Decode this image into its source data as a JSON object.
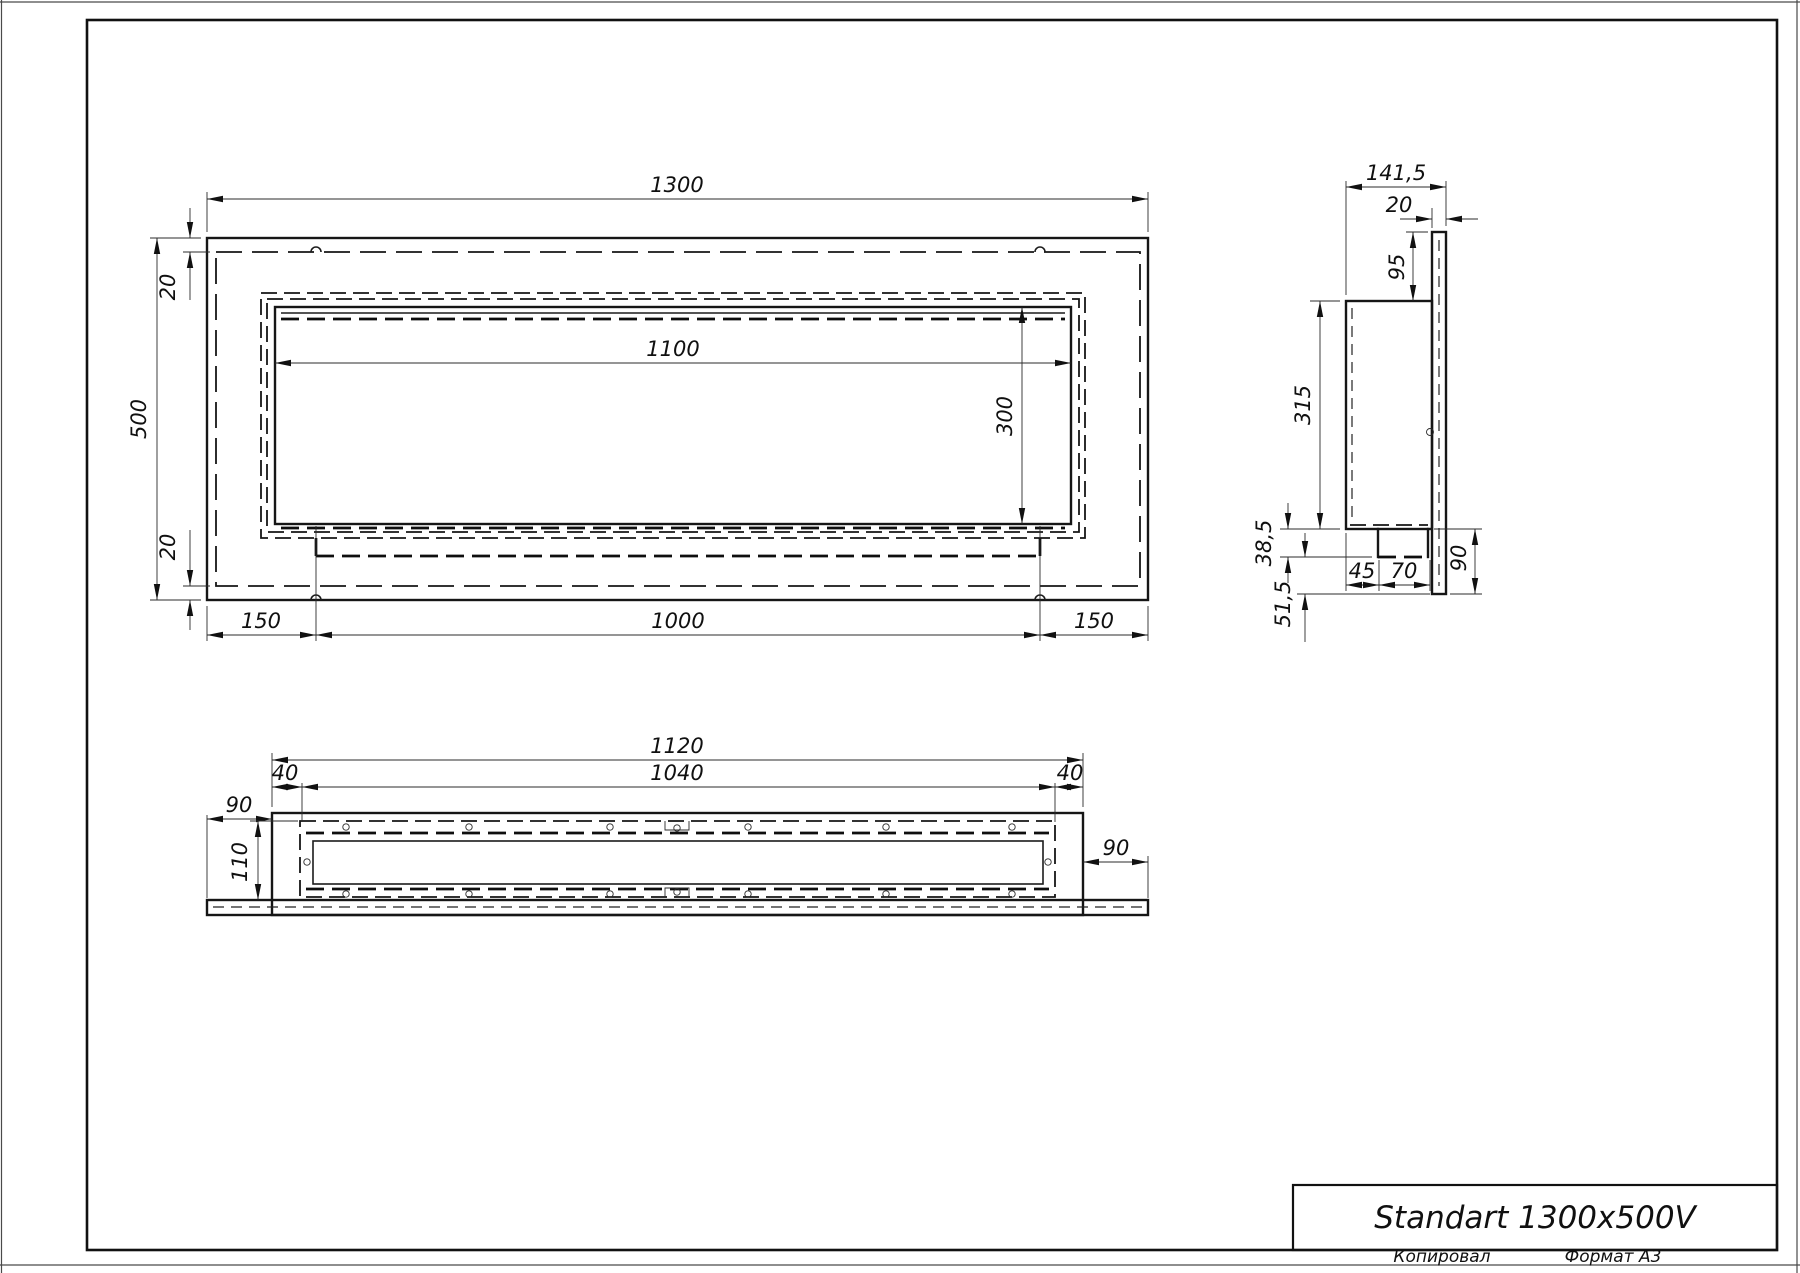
{
  "title_block": {
    "model": "Standart 1300x500V",
    "copied_label": "Копировал",
    "format_label": "Формат А3"
  },
  "front_view": {
    "overall_width": "1300",
    "overall_height": "500",
    "top_inset": "20",
    "bottom_inset": "20",
    "opening_width": "1100",
    "opening_height": "300",
    "mount_left": "150",
    "mount_span": "1000",
    "mount_right": "150"
  },
  "side_view": {
    "overall_depth": "141,5",
    "flange_thickness": "20",
    "top_offset": "95",
    "body_depth": "315",
    "tray_step": "38,5",
    "tray_offset": "45",
    "tray_width": "70",
    "flange_drop": "90",
    "bottom_clearance": "51,5"
  },
  "bottom_view": {
    "housing_width": "1120",
    "opening_width": "1040",
    "margin_left": "40",
    "margin_right": "40",
    "overhang_left": "90",
    "overhang_right": "90",
    "housing_depth": "110"
  }
}
